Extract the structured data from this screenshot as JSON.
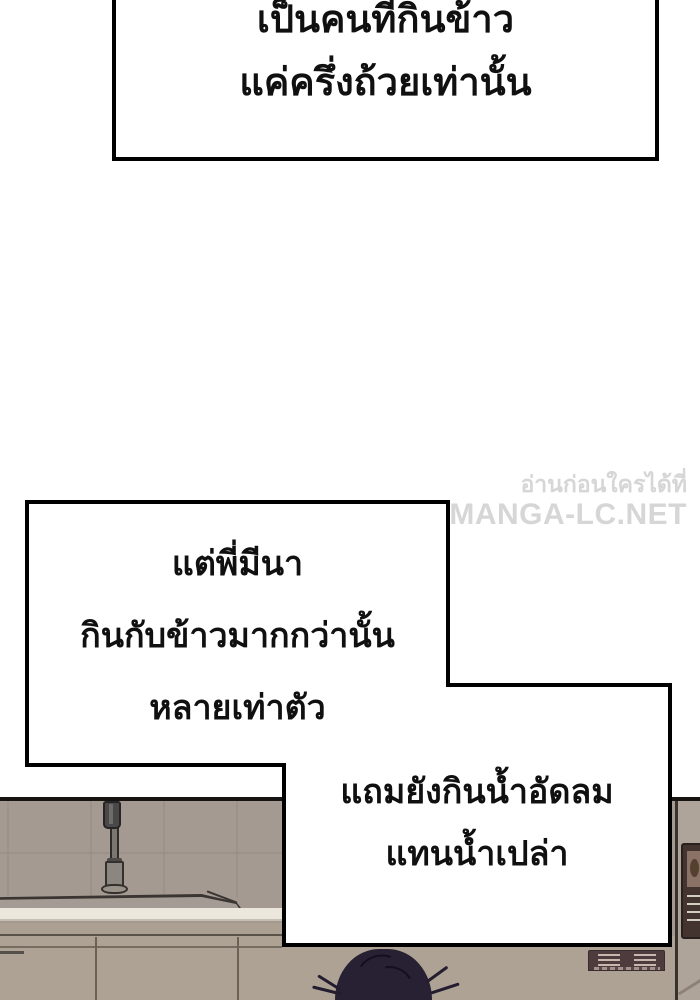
{
  "bubbles": {
    "top": {
      "line1": "เป็นคนที่กินข้าว",
      "line2": "แค่ครึ่งถ้วยเท่านั้น"
    },
    "middle": {
      "line1": "แต่พี่มีนา",
      "line2": "กินกับข้าวมากกว่านั้น",
      "line3": "หลายเท่าตัว"
    },
    "bottom": {
      "line1": "แถมยังกินน้ำอัดลม",
      "line2": "แทนน้ำเปล่า"
    }
  },
  "watermark": {
    "line1": "อ่านก่อนใครได้ที่",
    "line2": "MANGA-LC.NET",
    "color": "#d6d6d6"
  },
  "colors": {
    "page_background": "#ffffff",
    "bubble_fill": "#ffffff",
    "bubble_border": "#000000",
    "bubble_text": "#101010",
    "kitchen_wall": "#a59a91",
    "kitchen_top_border": "#161412",
    "countertop_white": "#ece7dc",
    "cabinet": "#ada294",
    "faucet_gray": "#8b8680",
    "hair": "#282133",
    "control_panel": "#4e3b3d",
    "poster_frame": "#44342f"
  }
}
